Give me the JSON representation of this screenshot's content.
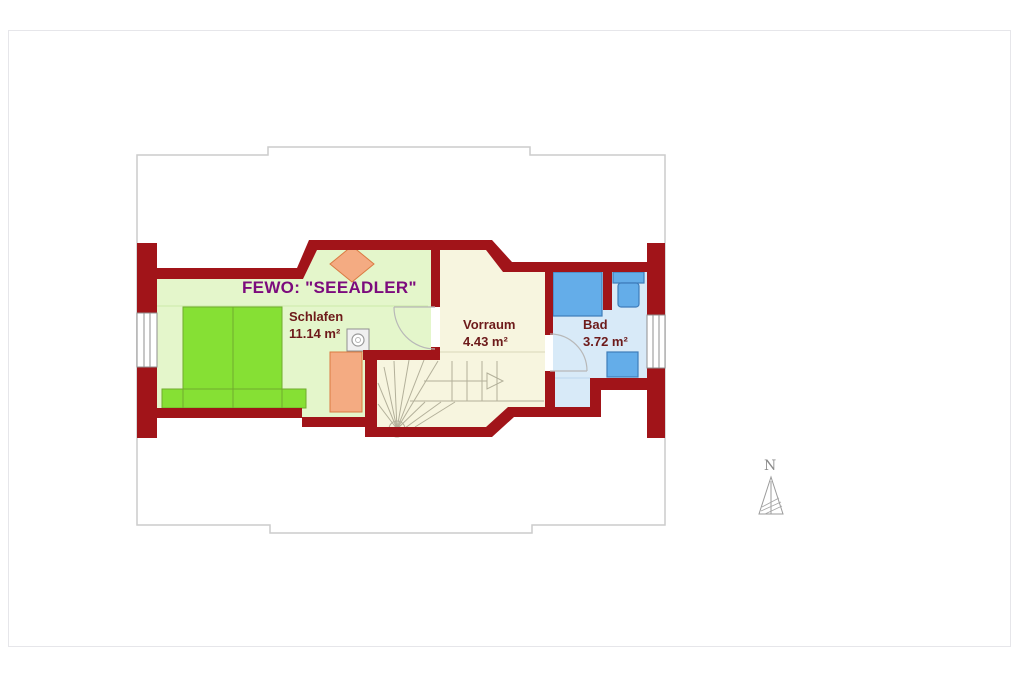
{
  "window": {
    "background": "#ffffff"
  },
  "floorplan": {
    "title": "FEWO: \"SEEADLER\"",
    "rooms": [
      {
        "name": "Schlafen",
        "area": "11.14 m²"
      },
      {
        "name": "Vorraum",
        "area": "4.43 m²"
      },
      {
        "name": "Bad",
        "area": "3.72 m²"
      }
    ],
    "compass": {
      "label": "N"
    },
    "colors": {
      "wall_red": "#a11419",
      "bedroom_floor": "#e4f6cb",
      "hall_floor": "#f7f5df",
      "bath_floor": "#d8eaf8",
      "fixture_blue": "#64ade9",
      "bed_green": "#86e034",
      "furniture_orange": "#f4ab82",
      "title_purple": "#7c0b7d",
      "label_maroon": "#6d1a1a",
      "roof_outline_gray": "#cccccc"
    },
    "furniture_icons": [
      "double-bed",
      "wardrobe",
      "seat-cushion",
      "washing-machine",
      "shower",
      "toilet",
      "washbasin",
      "winder-staircase"
    ]
  }
}
